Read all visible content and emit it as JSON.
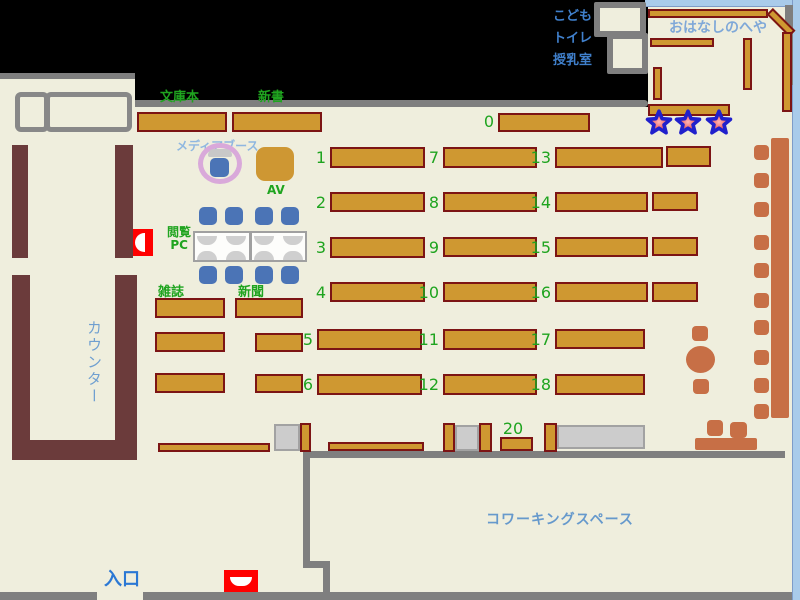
{
  "map": {
    "title_area": "library-floor-map",
    "areas": {
      "paperbacks": "文庫本",
      "new_books": "新書",
      "media_booth": "メディアブース",
      "av": "AV",
      "reading_pc_lines": [
        "閲覧",
        "PC"
      ],
      "magazines": "雑誌",
      "newspapers": "新聞",
      "counter": "カウンター",
      "entrance": "入口",
      "coworking": "コワーキングスペース",
      "story_room": "おはなしのへや",
      "kids_block_lines": [
        "こども",
        "トイレ",
        "授乳室"
      ]
    },
    "shelf_numbers": {
      "n0": "0",
      "n1": "1",
      "n2": "2",
      "n3": "3",
      "n4": "4",
      "n5": "5",
      "n6": "6",
      "n7": "7",
      "n8": "8",
      "n9": "9",
      "n10": "10",
      "n11": "11",
      "n12": "12",
      "n13": "13",
      "n14": "14",
      "n15": "15",
      "n16": "16",
      "n17": "17",
      "n18": "18",
      "n20": "20"
    },
    "colors": {
      "floor": "#EFEEDD",
      "wall_gray": "#7F7F7F",
      "shelf_fill": "#CF9831",
      "shelf_border": "#7C1414",
      "counter_brown": "#6B3B3B",
      "label_green": "#1FA41F",
      "label_blue": "#4080CC",
      "counter_text_blue": "#6F9FD0",
      "entrance_text_blue": "#2B78D4",
      "coworking_text_blue": "#6699CC",
      "story_text_blue": "#7FA8D8",
      "media_text_blue": "#8FB7E0",
      "chair_blue": "#4B74B6",
      "terracotta": "#C76F46",
      "highlight_red": "#FF0000",
      "star_fill": "#E23030",
      "star_border": "#2020CC",
      "frame_blue": "#A9CBEA",
      "booth_ring_pink": "#D9A9DA"
    }
  }
}
